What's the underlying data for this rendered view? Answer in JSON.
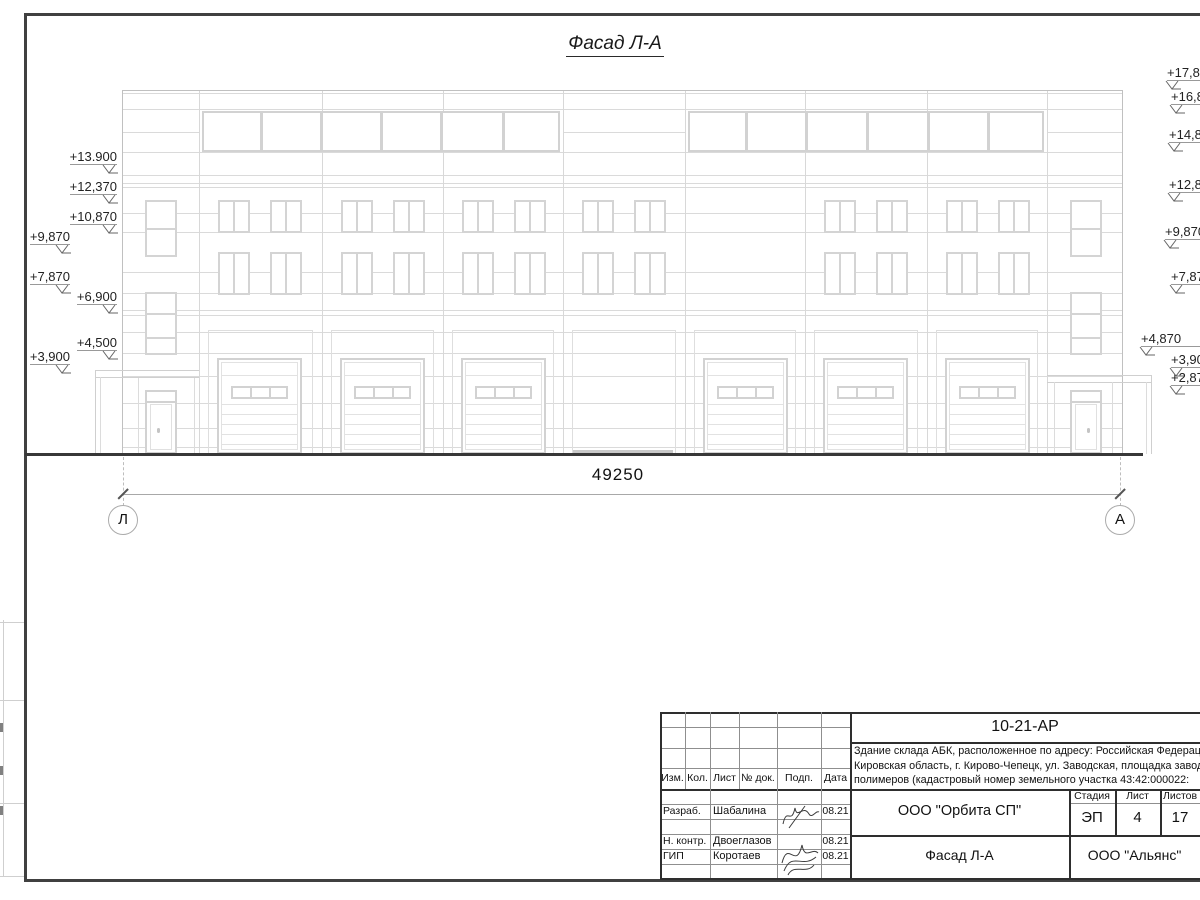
{
  "sheet": {
    "drawing_title": "Фасад Л-А",
    "dimension_label": "49250",
    "axis_left": "Л",
    "axis_right": "А",
    "elevation_marks_left": [
      "+13.900",
      "+12,370",
      "+10,870",
      "+9,870",
      "+7,870",
      "+6,900",
      "+4,500",
      "+3,900"
    ],
    "elevation_marks_right": [
      "+17,870",
      "+16,870",
      "+14,870",
      "+12,870",
      "+9,870",
      "+7,870",
      "+4,870",
      "+3,900",
      "+2,870"
    ],
    "title_block": {
      "project_code": "10-21-АР",
      "description_lines": [
        "Здание склада АБК, расположенное по адресу: Российская Федерация,",
        "Кировская область, г. Кирово-Чепецк, ул. Заводская, площадка завода",
        "полимеров (кадастровый номер земельного участка 43:42:000022:"
      ],
      "revision_columns": [
        "Изм.",
        "Кол.",
        "Лист",
        "№ док.",
        "Подп.",
        "Дата"
      ],
      "signature_rows": [
        {
          "role": "Разраб.",
          "name": "Шабалина",
          "date": "08.21"
        },
        {
          "role": "Н. контр.",
          "name": "Двоеглазов",
          "date": "08.21"
        },
        {
          "role": "ГИП",
          "name": "Коротаев",
          "date": "08.21"
        }
      ],
      "organization": "ООО \"Орбита СП\"",
      "stage_label": "Стадия",
      "sheet_label": "Лист",
      "sheets_label": "Листов",
      "stage": "ЭП",
      "sheet_number": "4",
      "sheets_total": "17",
      "sheet_title": "Фасад Л-А",
      "contractor": "ООО \"Альянс\""
    }
  }
}
